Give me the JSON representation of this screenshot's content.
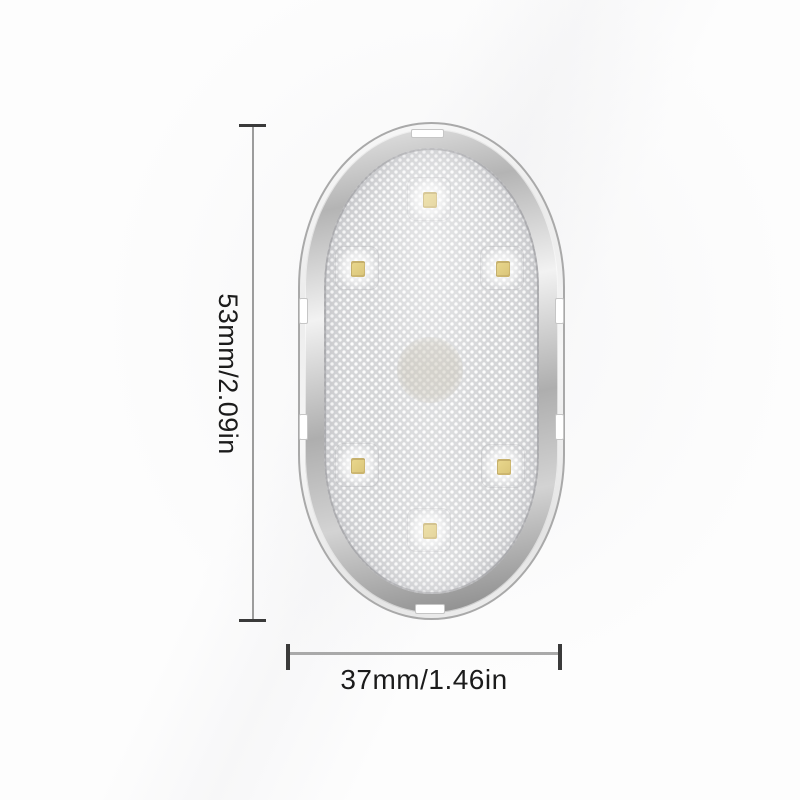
{
  "diagram": {
    "kind": "product-dimension-diagram",
    "item": "oval LED touch light",
    "led_count": 6,
    "has_touch_sensor_circle": true
  },
  "dimensions": {
    "height_label": "53mm/2.09in",
    "width_label": "37mm/1.46in"
  },
  "colors": {
    "background": "#fdfdfd",
    "face": "#d5d6d8",
    "led_chip": "#ead88e",
    "dim_line": "#9c9c9c",
    "dim_tick": "#3a3a3a",
    "text": "#1b1b1b"
  }
}
